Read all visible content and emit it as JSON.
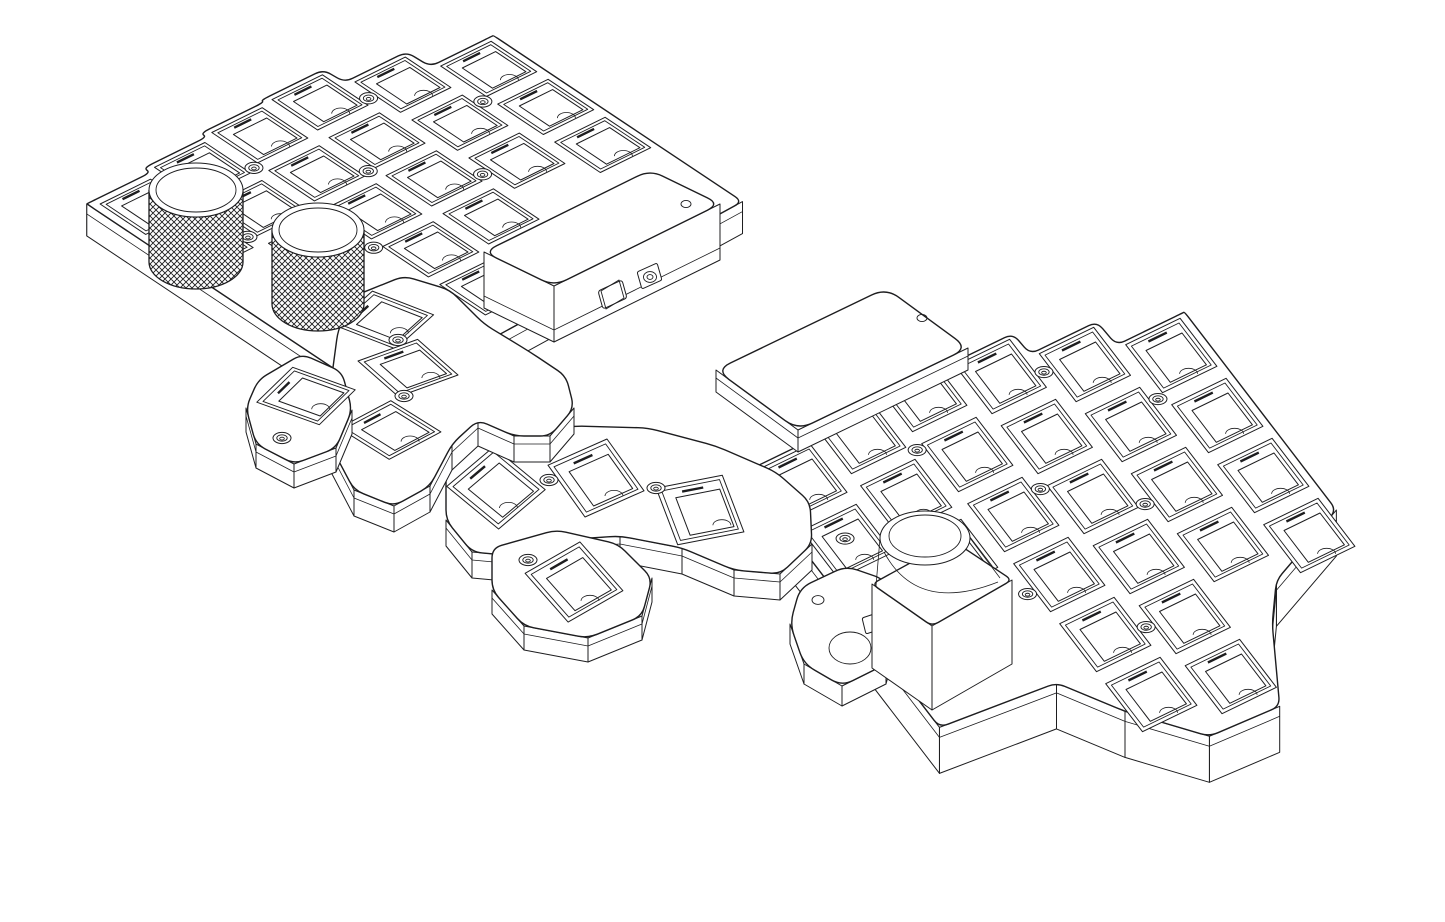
{
  "scene": {
    "description": "Monochrome CAD wireframe drawing of a split ergonomic keyboard viewed in isometric projection: left half with two knurled rotary knobs and a connector pod, right half with an electronics cover plate and a trackball mount housing; both halves have waffle-grid key switch sockets and fanned thumb-key clusters",
    "width": 1445,
    "height": 922,
    "background": "#ffffff",
    "line_color": "#1d1d1f"
  },
  "components": {
    "left_half": {
      "label": "Left keyboard half switch plate and case",
      "plate_key_sockets": 20,
      "thumb_cluster": {
        "label": "Left thumb key cluster",
        "keys": 3
      },
      "outer_thumb_piece": {
        "label": "Detached outer thumb key piece",
        "keys": 1
      },
      "knobs": [
        {
          "label": "Knurled rotary encoder knob (rear)"
        },
        {
          "label": "Knurled rotary encoder knob (front)"
        }
      ],
      "connector_pod": {
        "label": "Controller / connector pod",
        "ports": [
          {
            "label": "USB port"
          },
          {
            "label": "TRRS jack"
          }
        ],
        "indicator_holes": 1
      }
    },
    "right_half": {
      "label": "Right keyboard half switch plate and case",
      "plate_key_sockets": 25,
      "thumb_cluster": {
        "label": "Right thumb key cluster",
        "keys": 3
      },
      "outer_thumb_piece": {
        "label": "Detached outer thumb key piece",
        "keys": 1
      },
      "cover": {
        "label": "Electronics cover plate",
        "screw_holes": 1
      },
      "pointer_module": {
        "label": "Trackball / encoder mount housing"
      }
    }
  },
  "drawing": {
    "stroke": "#1d1d1f",
    "left": {
      "origin": [
        52,
        188
      ],
      "u": [
        63,
        -31
      ],
      "v": [
        57,
        38
      ],
      "depth": 32,
      "west_u": 0.1,
      "east_u": 6.12,
      "vb": [
        0.5,
        0.38,
        0.28,
        0.23,
        0.58,
        0.98
      ],
      "stagger": [
        0.15,
        0.0,
        -0.1,
        -0.15,
        0.2,
        0.6
      ],
      "rows": [
        2,
        3,
        4,
        4,
        3,
        3
      ],
      "extra_keys": [
        [
          2,
          4
        ]
      ],
      "tail": [
        [
          6.12,
          5.35
        ],
        [
          0.1,
          5.65
        ]
      ],
      "screws": [
        [
          2.12,
          1.2
        ],
        [
          4.12,
          1.0
        ],
        [
          1.12,
          2.2
        ],
        [
          3.12,
          2.1
        ],
        [
          5.12,
          1.9
        ],
        [
          2.12,
          3.3
        ],
        [
          4.12,
          3.0
        ]
      ],
      "knobs": [
        {
          "c": [
            196,
            262
          ],
          "r": 47,
          "h": 72
        },
        {
          "c": [
            318,
            304
          ],
          "r": 46,
          "h": 74
        }
      ],
      "pod": {
        "top": [
          [
            484,
            252
          ],
          [
            650,
            170
          ],
          [
            720,
            204
          ],
          [
            554,
            286
          ]
        ],
        "depth": 56,
        "corner": 14,
        "usb": [
          [
            598,
            291
          ],
          [
            622,
            280
          ],
          [
            627,
            298
          ],
          [
            603,
            309
          ]
        ],
        "trrs_bezel": [
          [
            637,
            272
          ],
          [
            657,
            263
          ],
          [
            662,
            280
          ],
          [
            642,
            289
          ]
        ],
        "trrs_center": [
          650,
          277
        ],
        "hole": [
          686,
          204
        ]
      },
      "arm": {
        "outline": [
          [
            354,
            296
          ],
          [
            404,
            276
          ],
          [
            450,
            290
          ],
          [
            484,
            324
          ],
          [
            530,
            352
          ],
          [
            566,
            376
          ],
          [
            574,
            408
          ],
          [
            550,
            436
          ],
          [
            514,
            436
          ],
          [
            478,
            420
          ],
          [
            452,
            444
          ],
          [
            430,
            486
          ],
          [
            394,
            506
          ],
          [
            354,
            490
          ],
          [
            332,
            448
          ],
          [
            330,
            390
          ],
          [
            338,
            330
          ]
        ],
        "depth": 26,
        "keys": [
          [
            384,
            320,
            -16
          ],
          [
            408,
            368,
            8
          ],
          [
            390,
            430,
            -2
          ]
        ],
        "screws": [
          [
            398,
            340
          ],
          [
            404,
            396
          ]
        ]
      },
      "piece": {
        "outline": [
          [
            258,
            380
          ],
          [
            302,
            354
          ],
          [
            342,
            372
          ],
          [
            352,
            410
          ],
          [
            336,
            448
          ],
          [
            294,
            464
          ],
          [
            256,
            444
          ],
          [
            246,
            408
          ]
        ],
        "depth": 24,
        "keys": [
          [
            306,
            396,
            -18
          ]
        ],
        "screws": [
          [
            282,
            438
          ]
        ]
      }
    },
    "right": {
      "origin": [
        704,
        430
      ],
      "u": [
        68,
        -33
      ],
      "v": [
        46,
        60
      ],
      "depth": 46,
      "west_u": 0.08,
      "east_u": 6.12,
      "vb": [
        0.75,
        0.55,
        0.4,
        0.65,
        1.0,
        1.4
      ],
      "stagger": [
        0.35,
        0.15,
        0.0,
        0.25,
        0.6,
        1.0
      ],
      "rows": [
        2,
        3,
        6,
        6,
        4,
        4
      ],
      "extra_keys": [],
      "front_pts": [
        [
          0.08,
          5.0
        ],
        [
          1.7,
          5.15
        ],
        [
          2.2,
          5.9
        ],
        [
          2.9,
          6.7
        ],
        [
          3.9,
          6.75
        ],
        [
          4.5,
          5.7
        ],
        [
          4.9,
          5.2
        ],
        [
          6.12,
          4.7
        ]
      ],
      "screws": [
        [
          2.12,
          1.5
        ],
        [
          4.12,
          1.3
        ],
        [
          0.62,
          2.15
        ],
        [
          3.12,
          2.7
        ],
        [
          5.12,
          2.3
        ],
        [
          2.12,
          3.9
        ],
        [
          4.12,
          3.5
        ],
        [
          3.12,
          5.0
        ]
      ],
      "cover": {
        "top": [
          [
            716,
            370
          ],
          [
            886,
            288
          ],
          [
            968,
            348
          ],
          [
            798,
            430
          ]
        ],
        "depth": 22,
        "corner": 16,
        "hole": [
          922,
          318
        ]
      },
      "ball": {
        "ear": [
          [
            800,
            588
          ],
          [
            846,
            566
          ],
          [
            886,
            580
          ],
          [
            898,
            620
          ],
          [
            886,
            664
          ],
          [
            842,
            686
          ],
          [
            804,
            664
          ],
          [
            790,
            624
          ]
        ],
        "ear_hole": [
          818,
          600
        ],
        "ear_tab": [
          [
            862,
            618
          ],
          [
            886,
            610
          ],
          [
            890,
            626
          ],
          [
            866,
            634
          ]
        ],
        "ear_cut": [
          850,
          648,
          21,
          16
        ],
        "box": [
          [
            872,
            584
          ],
          [
            952,
            540
          ],
          [
            1012,
            580
          ],
          [
            932,
            626
          ]
        ],
        "box_depth": 84,
        "cyl": [
          925,
          538,
          45,
          27
        ]
      },
      "arm": {
        "outline": [
          [
            446,
            468
          ],
          [
            476,
            444
          ],
          [
            520,
            432
          ],
          [
            576,
            426
          ],
          [
            648,
            428
          ],
          [
            716,
            446
          ],
          [
            776,
            472
          ],
          [
            810,
            502
          ],
          [
            812,
            544
          ],
          [
            780,
            574
          ],
          [
            734,
            570
          ],
          [
            682,
            548
          ],
          [
            620,
            536
          ],
          [
            560,
            540
          ],
          [
            516,
            556
          ],
          [
            472,
            552
          ],
          [
            446,
            520
          ]
        ],
        "depth": 26,
        "keys": [
          [
            496,
            488,
            -14
          ],
          [
            596,
            478,
            2
          ],
          [
            700,
            510,
            16
          ]
        ],
        "screws": [
          [
            549,
            480
          ],
          [
            656,
            488
          ]
        ]
      },
      "piece": {
        "outline": [
          [
            492,
            548
          ],
          [
            556,
            530
          ],
          [
            618,
            544
          ],
          [
            652,
            578
          ],
          [
            642,
            616
          ],
          [
            588,
            638
          ],
          [
            524,
            626
          ],
          [
            492,
            590
          ]
        ],
        "depth": 24,
        "keys": [
          [
            574,
            582,
            -4
          ]
        ],
        "screws": [
          [
            528,
            560
          ]
        ]
      }
    }
  }
}
